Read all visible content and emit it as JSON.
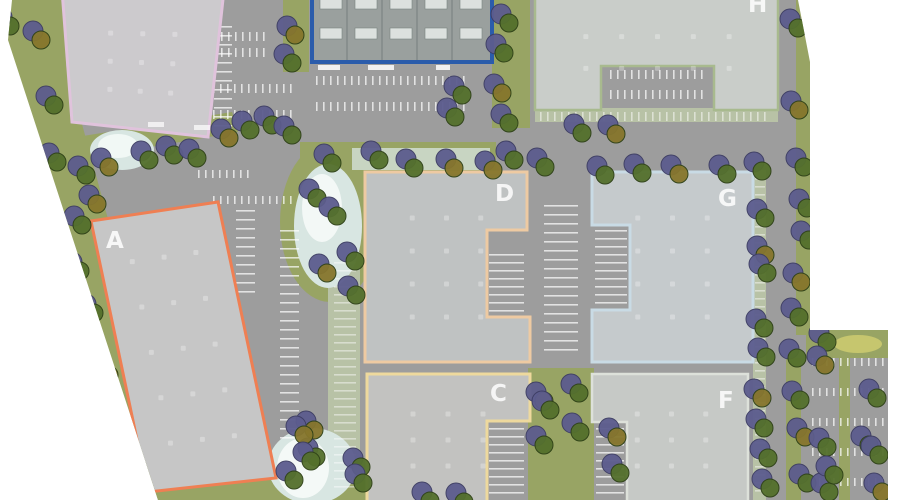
{
  "buildings": [
    {
      "id": "building-a",
      "label": "A",
      "outline_color": "#ef7f53"
    },
    {
      "id": "building-c",
      "label": "C",
      "outline_color": "#eed99d"
    },
    {
      "id": "building-d",
      "label": "D",
      "outline_color": "#eecaa2"
    },
    {
      "id": "building-f",
      "label": "F",
      "outline_color": "#dde1da"
    },
    {
      "id": "building-g",
      "label": "G",
      "outline_color": "#c9dbe5"
    },
    {
      "id": "building-h",
      "label": "H",
      "outline_color": "#a8ba8e"
    },
    {
      "id": "building-northwest",
      "label": "",
      "outline_color": "#e0c3dc"
    },
    {
      "id": "building-north",
      "label": "",
      "outline_color": "#2b5cab"
    }
  ],
  "colors": {
    "background": "#ffffff",
    "grass": "#98a464",
    "hedge": "#b8c2a6",
    "pavement": "#9d9d9d",
    "water": "#d8e6e2",
    "water_highlight": "#f6faf8",
    "stall_line": "#ffffff",
    "tree_canopy_purple": "#5c5c8e",
    "tree_canopy_green": "#54702c",
    "tree_canopy_gold": "#86762c",
    "building_fill": "#c8c9c7",
    "building_label": "#ffffff"
  }
}
